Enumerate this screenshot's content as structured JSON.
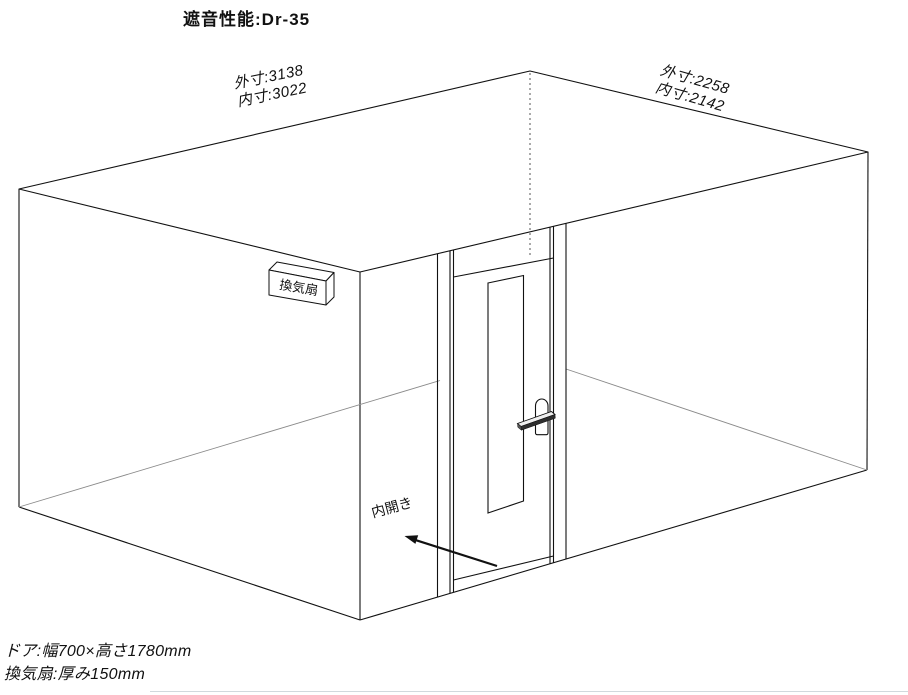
{
  "page": {
    "title": "遮音性能:Dr-35",
    "background_color": "#ffffff",
    "line_color": "#111111"
  },
  "diagram": {
    "type": "soundproof-room-3d-wireframe",
    "labels": {
      "title": "遮音性能:Dr-35",
      "dim_front_outer": "外寸:3138",
      "dim_front_inner": "内寸:3022",
      "dim_side_outer": "外寸:2258",
      "dim_side_inner": "内寸:2142",
      "vent_fan": "換気扇",
      "door_swing": "内開き",
      "note_door": "ドア:幅700×高さ1780mm",
      "note_vent": "換気扇:厚み150mm"
    }
  }
}
